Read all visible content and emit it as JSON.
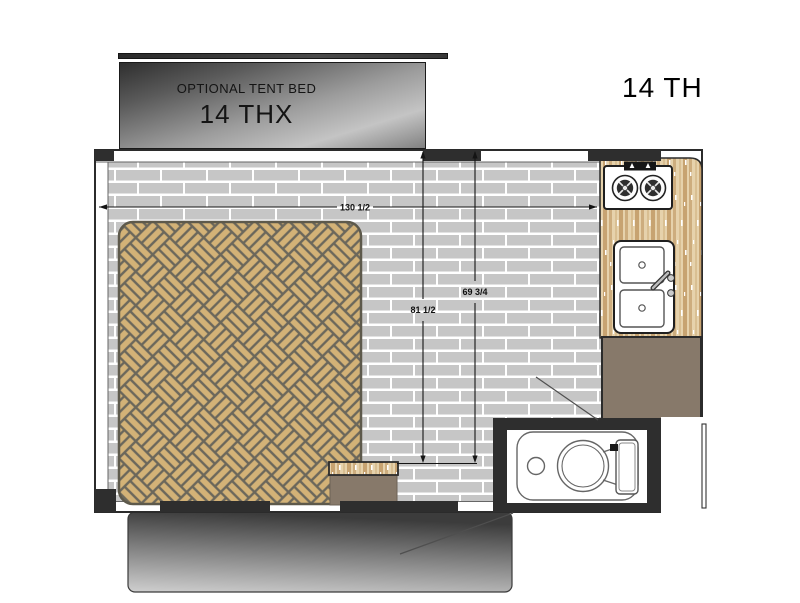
{
  "header": {
    "model_label": "14 TH"
  },
  "tent_bed": {
    "title": "OPTIONAL TENT BED",
    "model": "14 THX"
  },
  "dimensions": {
    "overall_width": "130 1/2",
    "interior_left": "81 1/2",
    "interior_right": "69 3/4"
  },
  "fixtures": {
    "bed": "herringbone-mattress-icon",
    "cooktop": "two-burner-stove-icon",
    "sink": "double-basin-sink-icon",
    "toilet": "cassette-toilet-icon",
    "wardrobe": "cabinet-block-icon",
    "step": "storage-step-icon",
    "bumper": "rear-bumper-step-icon"
  },
  "colors": {
    "floor_brick": "#c6c6c6",
    "mortar": "#ffffff",
    "bed_wood": "#d3b277",
    "grout": "#6b675b",
    "counter_wood": "#e6d2ac",
    "wood_streak": "#cdad7e",
    "cabinet": "#87796a",
    "wall": "#2e2e2e",
    "tent_gradient_dark": "#2f2f2f",
    "tent_gradient_light": "#c4c4c4"
  }
}
